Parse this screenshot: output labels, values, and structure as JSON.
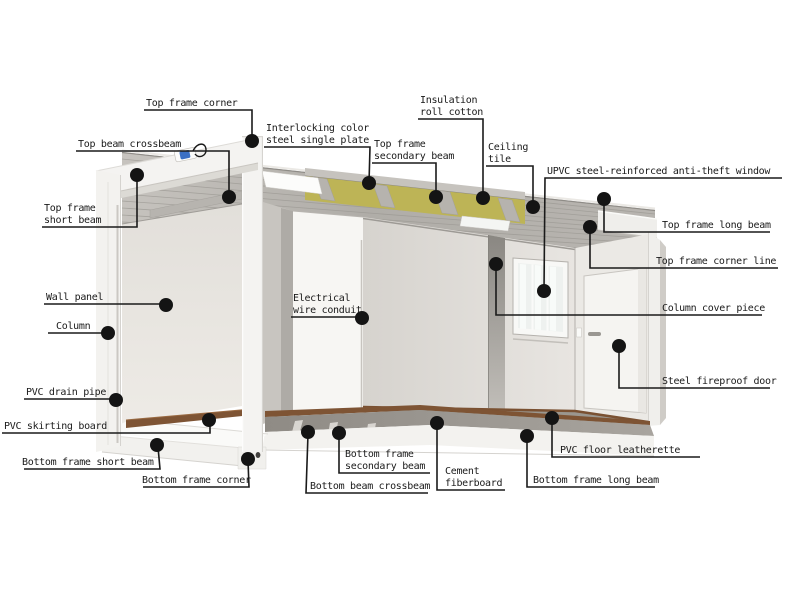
{
  "diagram": {
    "title_hidden": "",
    "colors": {
      "background": "#ffffff",
      "label_text": "#1a1a1a",
      "leader_line": "#1a1a1a",
      "anchor_dot": "#141414",
      "frame_white": "#f4f3f1",
      "ceiling_gray": "#b2afaa",
      "plate_gray": "#c6c3be",
      "insulation_yellow": "#bdb456",
      "wall_light": "#e9e6e1",
      "panel_white": "#f7f6f3",
      "floor_gray": "#9d9993",
      "skirting_brown": "#7e5434",
      "door_white": "#f5f4f1",
      "window_glass": "#eef1ef",
      "lock_blue": "#3a6fc4"
    },
    "labels": [
      {
        "id": "top-frame-corner",
        "lines": [
          "Top frame corner"
        ]
      },
      {
        "id": "top-beam-crossbeam",
        "lines": [
          "Top beam crossbeam"
        ]
      },
      {
        "id": "top-frame-short-beam",
        "lines": [
          "Top frame",
          "short beam"
        ]
      },
      {
        "id": "interlocking-color-steel-single-plate",
        "lines": [
          "Interlocking color",
          "steel single plate"
        ]
      },
      {
        "id": "top-frame-secondary-beam",
        "lines": [
          "Top frame",
          "secondary beam"
        ]
      },
      {
        "id": "insulation-roll-cotton",
        "lines": [
          "Insulation",
          "roll cotton"
        ]
      },
      {
        "id": "ceiling-tile",
        "lines": [
          "Ceiling",
          "tile"
        ]
      },
      {
        "id": "upvc-anti-theft-window",
        "lines": [
          "UPVC steel-reinforced anti-theft window"
        ]
      },
      {
        "id": "top-frame-long-beam",
        "lines": [
          "Top frame long beam"
        ]
      },
      {
        "id": "top-frame-corner-line",
        "lines": [
          "Top frame corner line"
        ]
      },
      {
        "id": "column-cover-piece",
        "lines": [
          "Column cover piece"
        ]
      },
      {
        "id": "steel-fireproof-door",
        "lines": [
          "Steel fireproof door"
        ]
      },
      {
        "id": "wall-panel",
        "lines": [
          "Wall panel"
        ]
      },
      {
        "id": "column",
        "lines": [
          "Column"
        ]
      },
      {
        "id": "pvc-drain-pipe",
        "lines": [
          "PVC drain pipe"
        ]
      },
      {
        "id": "pvc-skirting-board",
        "lines": [
          "PVC skirting board"
        ]
      },
      {
        "id": "bottom-frame-short-beam",
        "lines": [
          "Bottom frame short beam"
        ]
      },
      {
        "id": "bottom-frame-corner",
        "lines": [
          "Bottom frame corner"
        ]
      },
      {
        "id": "bottom-frame-secondary-beam",
        "lines": [
          "Bottom frame",
          "secondary beam"
        ]
      },
      {
        "id": "bottom-beam-crossbeam",
        "lines": [
          "Bottom beam crossbeam"
        ]
      },
      {
        "id": "cement-fiberboard",
        "lines": [
          "Cement",
          "fiberboard"
        ]
      },
      {
        "id": "bottom-frame-long-beam",
        "lines": [
          "Bottom frame long beam"
        ]
      },
      {
        "id": "pvc-floor-leatherette",
        "lines": [
          "PVC floor leatherette"
        ]
      },
      {
        "id": "electrical-wire-conduit",
        "lines": [
          "Electrical",
          "wire conduit"
        ]
      }
    ]
  }
}
